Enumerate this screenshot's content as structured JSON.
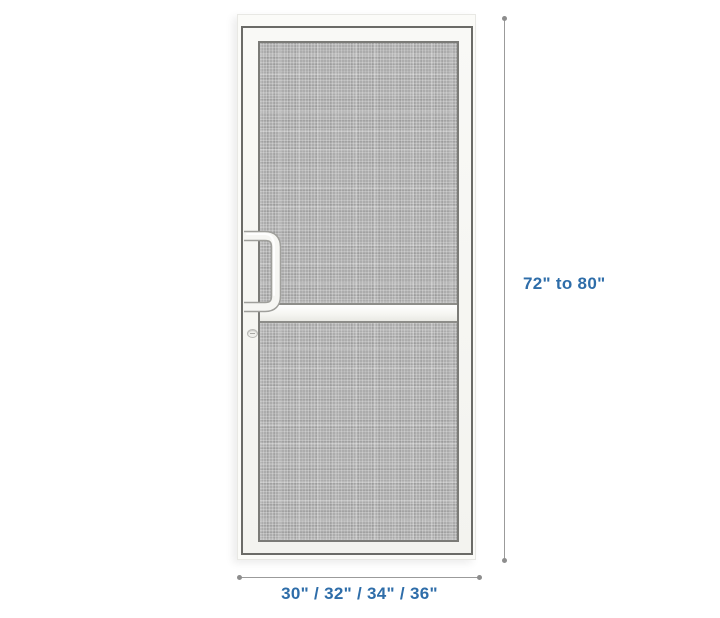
{
  "illustration": {
    "subject": "screen-door"
  },
  "dimensions": {
    "height_label": "72\" to 80\"",
    "width_label": "30\" / 32\" / 34\" / 36\""
  },
  "colors": {
    "label_blue": "#2e6da9",
    "dimension_line_gray": "#9b9b9b",
    "mesh_gray": "#acacac",
    "frame_white": "#fbfbf8",
    "frame_border_dark": "#6b6b67"
  }
}
